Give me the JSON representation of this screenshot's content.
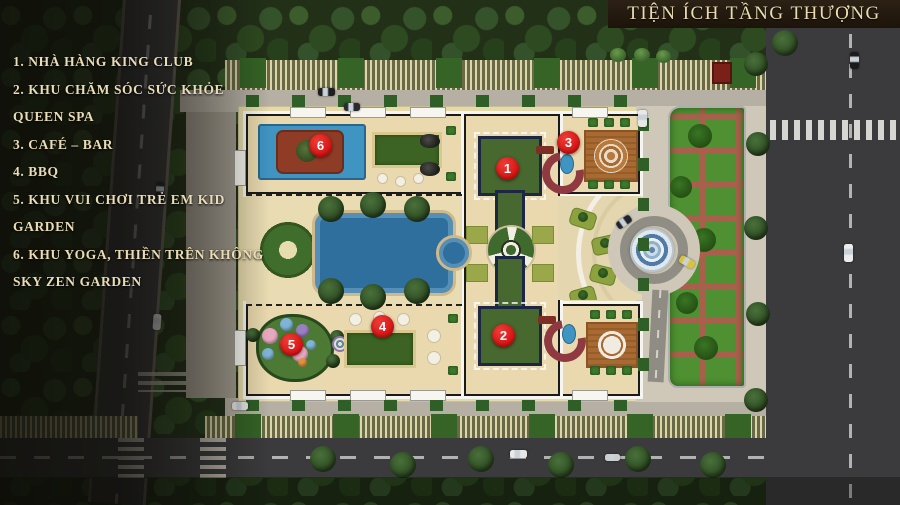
{
  "title_bar": {
    "text": "TIỆN ÍCH TẦNG THƯỢNG"
  },
  "legend": {
    "lines": [
      "1. NHÀ HÀNG KING CLUB",
      "2. KHU CHĂM SÓC SỨC KHỎE",
      "QUEEN SPA",
      "3. CAFÉ – BAR",
      "4. BBQ",
      "5. KHU VUI CHƠI TRẺ EM KID",
      "GARDEN",
      "6. KHU YOGA, THIỀN TRÊN KHÔNG",
      "SKY ZEN GARDEN"
    ]
  },
  "markers": [
    {
      "number": "1",
      "amenity": "Nhà hàng King Club"
    },
    {
      "number": "2",
      "amenity": "Khu chăm sóc sức khỏe Queen Spa"
    },
    {
      "number": "3",
      "amenity": "Café – Bar"
    },
    {
      "number": "4",
      "amenity": "BBQ"
    },
    {
      "number": "5",
      "amenity": "Khu vui chơi trẻ em Kid Garden"
    },
    {
      "number": "6",
      "amenity": "Khu yoga, thiền trên không Sky Zen Garden"
    }
  ],
  "colors": {
    "marker_red": "#d41313",
    "title_bg": "#241a11",
    "title_text": "#e9dcb0",
    "legend_text": "#e9dcb6",
    "pool_blue": "#2f6f9e",
    "lawn_green": "#3c6323",
    "parterre_green": "#4e9032",
    "deck_cream": "#e6daab"
  }
}
